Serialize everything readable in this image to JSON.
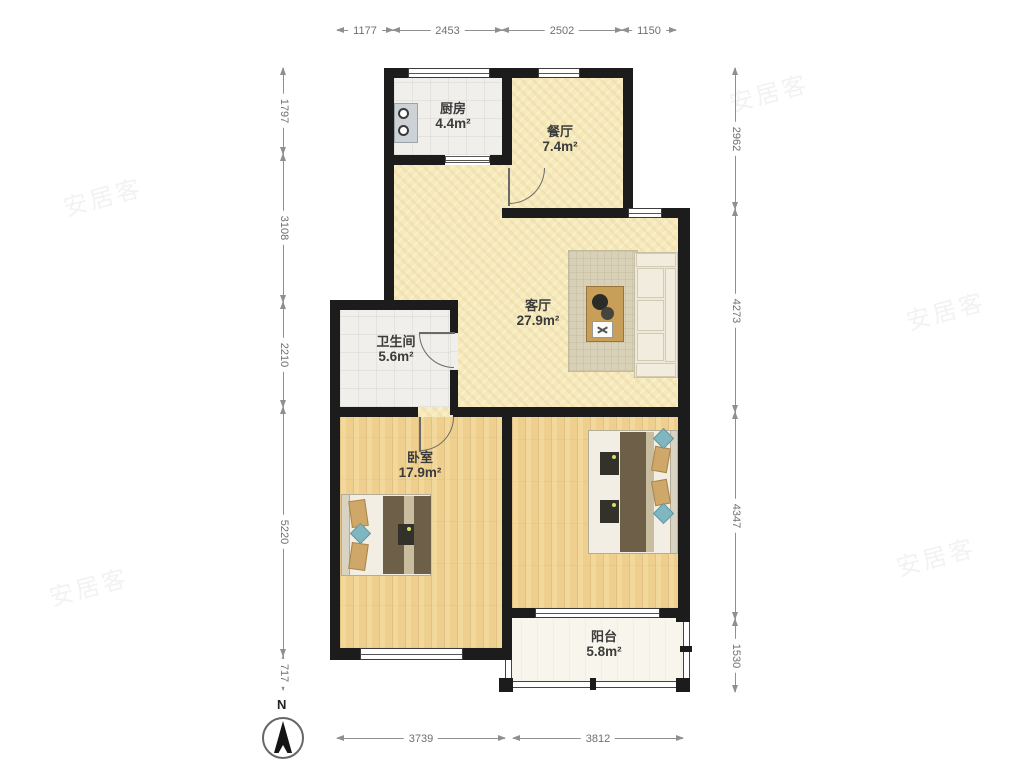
{
  "compass": {
    "label": "N"
  },
  "watermark": {
    "text": "安居客"
  },
  "rooms": {
    "kitchen": {
      "name": "厨房",
      "area": "4.4m²"
    },
    "dining": {
      "name": "餐厅",
      "area": "7.4m²"
    },
    "living": {
      "name": "客厅",
      "area": "27.9m²"
    },
    "bathroom": {
      "name": "卫生间",
      "area": "5.6m²"
    },
    "bedroom": {
      "name": "卧室",
      "area": "17.9m²"
    },
    "balcony": {
      "name": "阳台",
      "area": "5.8m²"
    }
  },
  "dimensions_mm": {
    "top": [
      "1177",
      "2453",
      "2502",
      "1150"
    ],
    "left": [
      "1797",
      "3108",
      "2210",
      "5220",
      "717"
    ],
    "right": [
      "2962",
      "4273",
      "4347",
      "1530"
    ],
    "bottom": [
      "3739",
      "3812"
    ]
  },
  "colors": {
    "wall": "#1c1c1c",
    "floor_public": "#f6e9bc",
    "floor_wood": "#eecf8d",
    "floor_tile": "#f0efeb",
    "floor_balcony": "#f8f6ec",
    "dimension_text": "#6f6f6f",
    "label_text": "#3b3b3b"
  }
}
